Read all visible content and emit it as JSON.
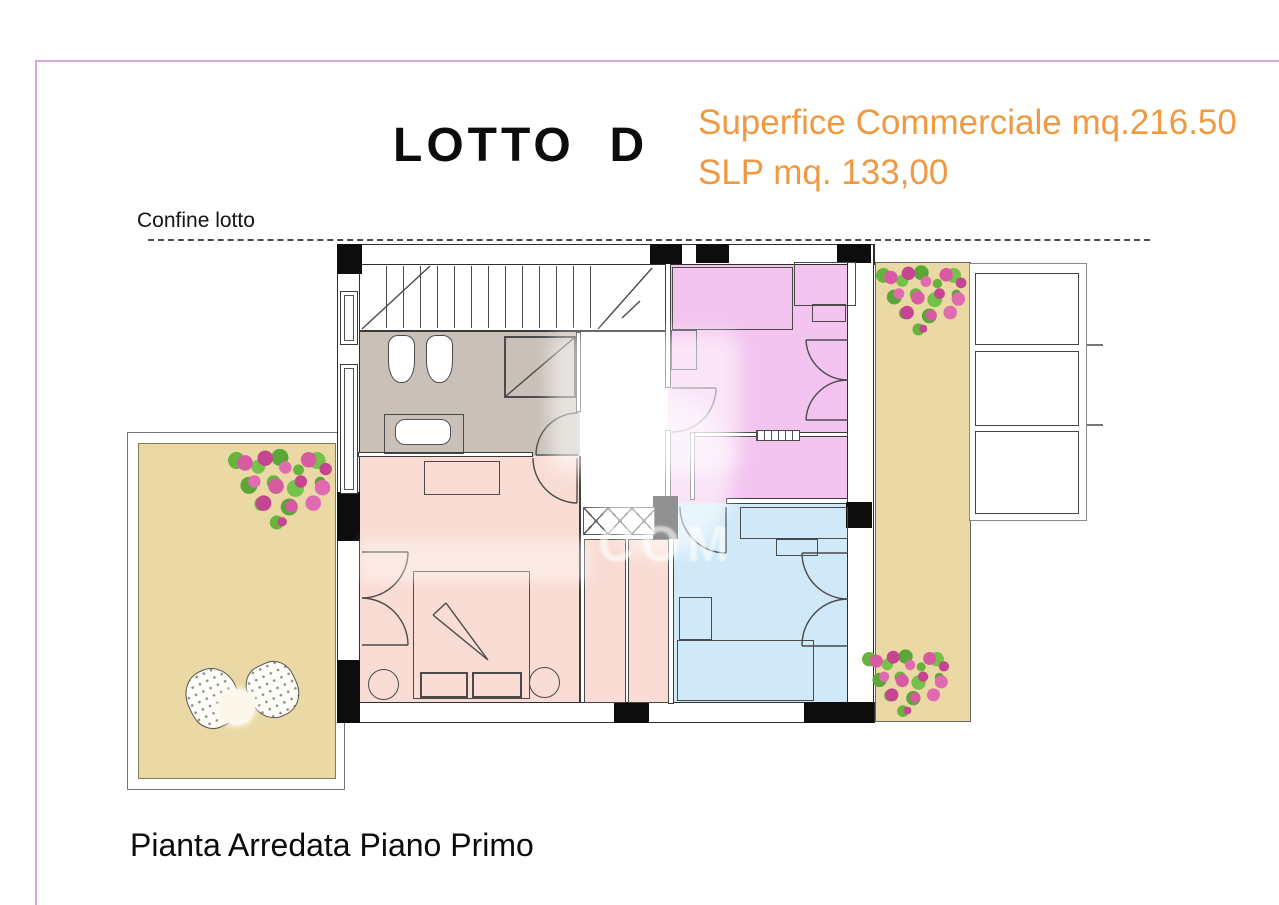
{
  "header": {
    "title": "LOTTO  D",
    "surface_line": "Superfice Commerciale mq.216.50",
    "slp_line": "SLP mq. 133,00",
    "accent_color": "#ef9a42"
  },
  "plan": {
    "boundary_label": "Confine lotto",
    "caption": "Pianta Arredata Piano Primo",
    "watermark_fragment": "COM",
    "frame_color": "#d4a8da",
    "colors": {
      "bathroom": "#c9c1b8",
      "bedroom_peach": "#f9ddd4",
      "bedroom_pink": "#f3c4ef",
      "bedroom_blue": "#cfe9f8",
      "deck": "#ead9a4",
      "wall": "#0d0d0d"
    }
  }
}
